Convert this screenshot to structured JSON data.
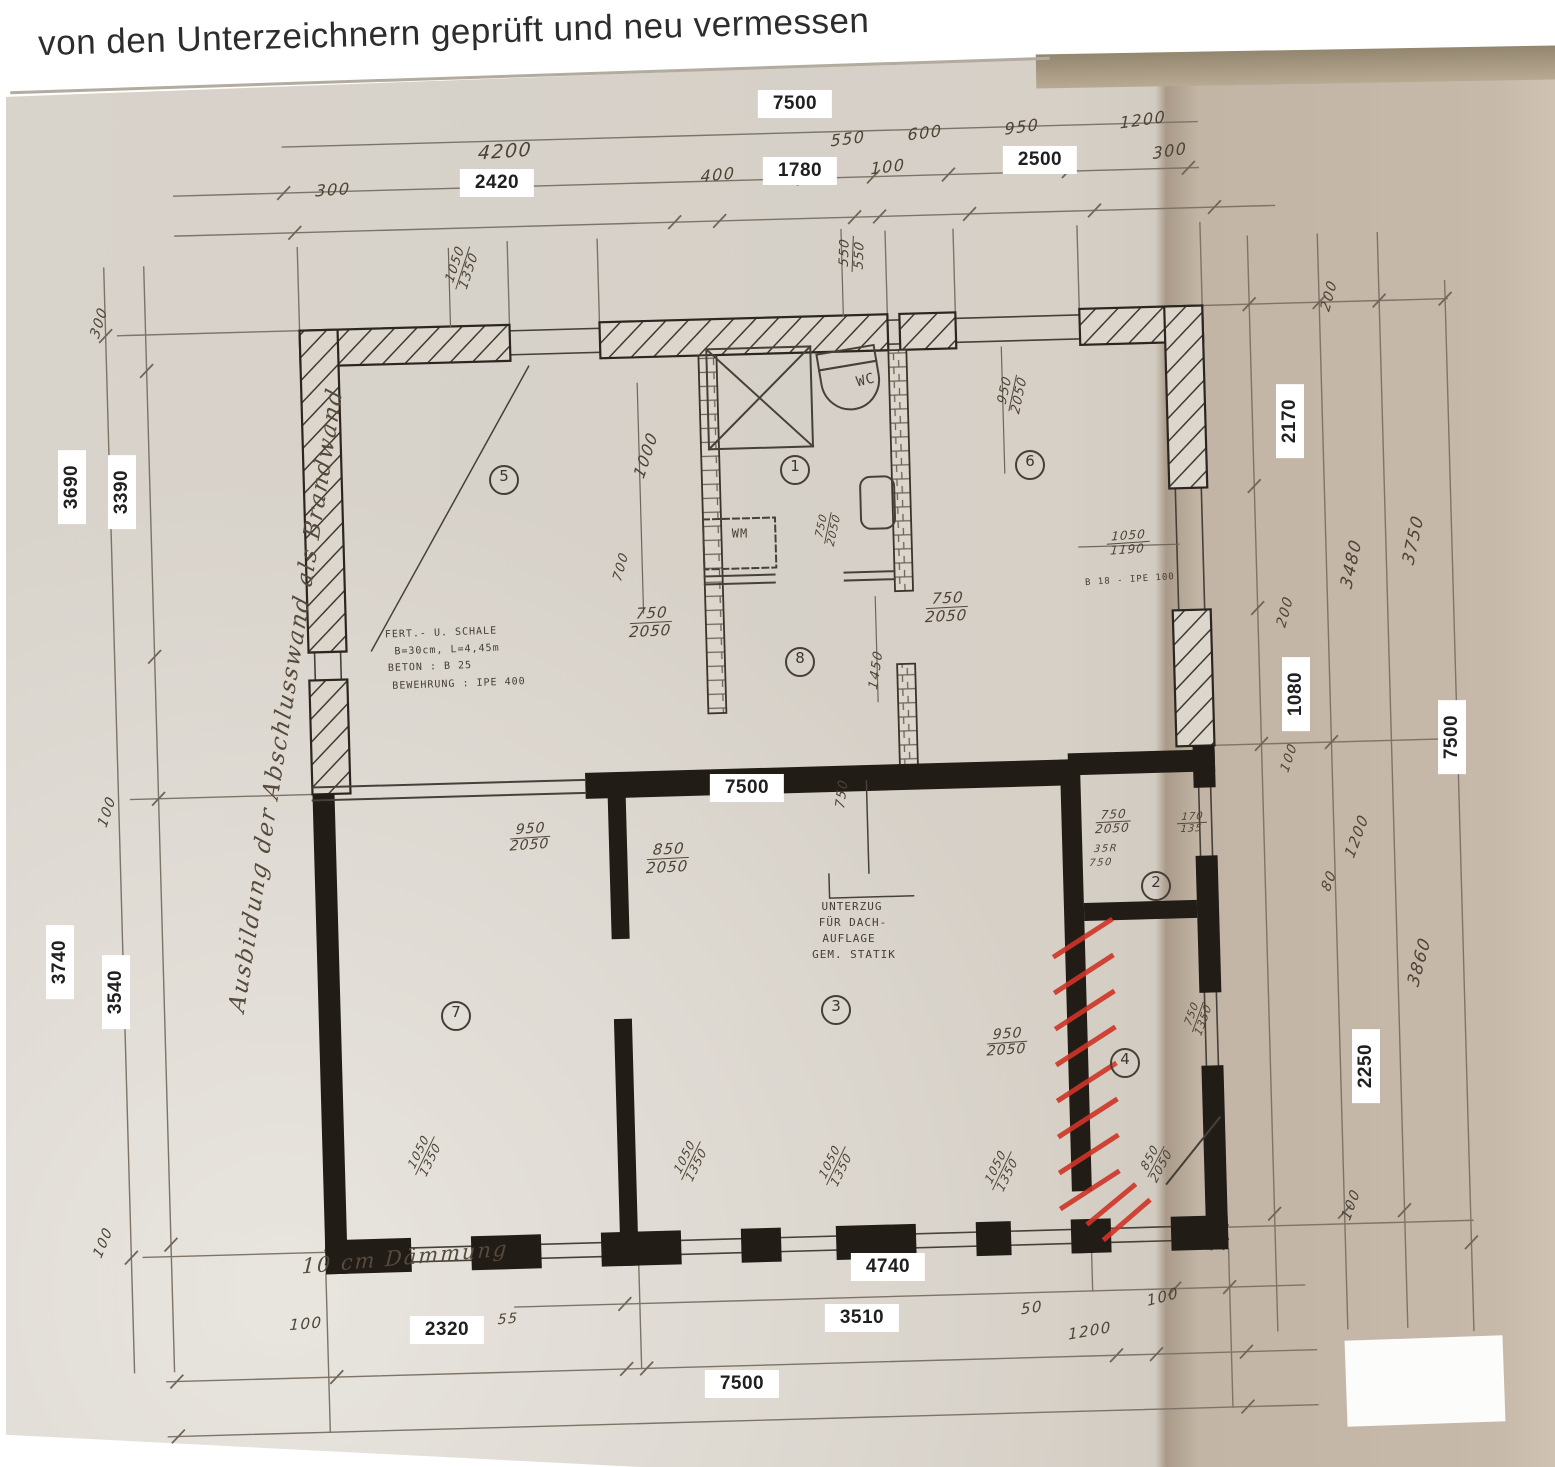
{
  "heading": "von den Unterzeichnern geprüft und neu vermessen",
  "margin_note": "Ausbildung der Abschlusswand als Brandwand",
  "insulation_note": "10 cm Dämmung",
  "beam_note_lines": [
    "UNTERZUG",
    "FÜR DACH-",
    "AUFLAGE",
    "GEM. STATIK"
  ],
  "shell_note_lines": [
    "FERT.- U. SCHALE",
    "B=30cm, L=4,45m",
    "BETON : B 25",
    "BEWEHRUNG : IPE 400"
  ],
  "room_numbers": [
    "1",
    "2",
    "3",
    "4",
    "5",
    "6",
    "7",
    "8"
  ],
  "dimension_chains": {
    "top": [
      [
        "7500"
      ],
      [
        "4200",
        "550",
        "600",
        "950",
        "1200"
      ],
      [
        "300",
        "2420",
        "400",
        "1780",
        "100",
        "2500",
        "300"
      ]
    ],
    "left": [
      [
        "300",
        "3690",
        "100",
        "3740",
        "100"
      ],
      [
        "3390",
        "3540"
      ]
    ],
    "right": [
      [
        "200",
        "2170",
        "200",
        "1080",
        "100",
        "1200",
        "80",
        "100"
      ],
      [
        "3480",
        "3860"
      ],
      [
        "3750",
        "2250"
      ],
      [
        "7500"
      ]
    ],
    "bottom": [
      [
        "4740",
        "50",
        "1200",
        "100"
      ],
      [
        "100",
        "2320",
        "55",
        "3510"
      ],
      [
        "7500"
      ]
    ]
  },
  "labels": [
    {
      "t": "7500",
      "x": 795,
      "y": 104,
      "c": "box"
    },
    {
      "t": "4200",
      "x": 505,
      "y": 152,
      "c": "hand",
      "r": -4,
      "fs": 19
    },
    {
      "t": "550",
      "x": 848,
      "y": 139,
      "c": "hand",
      "r": -7
    },
    {
      "t": "600",
      "x": 925,
      "y": 133,
      "c": "hand",
      "r": -7
    },
    {
      "t": "950",
      "x": 1022,
      "y": 127,
      "c": "hand",
      "r": -8
    },
    {
      "t": "1200",
      "x": 1143,
      "y": 120,
      "c": "hand",
      "r": -8
    },
    {
      "t": "300",
      "x": 333,
      "y": 190,
      "c": "hand",
      "r": -4
    },
    {
      "t": "2420",
      "x": 497,
      "y": 183,
      "c": "box"
    },
    {
      "t": "400",
      "x": 718,
      "y": 175,
      "c": "hand",
      "r": -6
    },
    {
      "t": "1780",
      "x": 800,
      "y": 171,
      "c": "box"
    },
    {
      "t": "100",
      "x": 888,
      "y": 167,
      "c": "hand",
      "r": -7
    },
    {
      "t": "2500",
      "x": 1040,
      "y": 160,
      "c": "box"
    },
    {
      "t": "300",
      "x": 1170,
      "y": 151,
      "c": "hand",
      "r": -9
    },
    {
      "t": "300",
      "x": 100,
      "y": 323,
      "c": "hand",
      "r": -73,
      "fs": 14
    },
    {
      "t": "3690",
      "x": 72,
      "y": 487,
      "c": "box",
      "r": -90
    },
    {
      "t": "3390",
      "x": 122,
      "y": 492,
      "c": "box",
      "r": -90
    },
    {
      "t": "100",
      "x": 108,
      "y": 812,
      "c": "hand",
      "r": -72,
      "fs": 14
    },
    {
      "t": "3740",
      "x": 60,
      "y": 962,
      "c": "box",
      "r": -90
    },
    {
      "t": "3540",
      "x": 116,
      "y": 992,
      "c": "box",
      "r": -90
    },
    {
      "t": "100",
      "x": 104,
      "y": 1243,
      "c": "hand",
      "r": -68,
      "fs": 14
    },
    {
      "t": "Ausbildung der Abschlusswand als Brandwand",
      "x": 287,
      "y": 700,
      "c": "script",
      "r": -81,
      "fs": 23
    },
    {
      "t": "200",
      "x": 1330,
      "y": 296,
      "c": "hand",
      "r": -75,
      "fs": 14
    },
    {
      "t": "2170",
      "x": 1290,
      "y": 421,
      "c": "box",
      "r": -90
    },
    {
      "t": "3480",
      "x": 1352,
      "y": 564,
      "c": "hand",
      "r": -78,
      "fs": 17
    },
    {
      "t": "3750",
      "x": 1414,
      "y": 540,
      "c": "hand",
      "r": -78,
      "fs": 17
    },
    {
      "t": "200",
      "x": 1286,
      "y": 612,
      "c": "hand",
      "r": -75,
      "fs": 14
    },
    {
      "t": "1080",
      "x": 1296,
      "y": 694,
      "c": "box",
      "r": -90
    },
    {
      "t": "100",
      "x": 1290,
      "y": 758,
      "c": "hand",
      "r": -72,
      "fs": 13
    },
    {
      "t": "7500",
      "x": 1452,
      "y": 737,
      "c": "box",
      "r": -90
    },
    {
      "t": "1200",
      "x": 1357,
      "y": 836,
      "c": "hand",
      "r": -70,
      "fs": 15
    },
    {
      "t": "80",
      "x": 1330,
      "y": 881,
      "c": "hand",
      "r": -70,
      "fs": 14
    },
    {
      "t": "3860",
      "x": 1420,
      "y": 962,
      "c": "hand",
      "r": -75,
      "fs": 17
    },
    {
      "t": "2250",
      "x": 1366,
      "y": 1066,
      "c": "box",
      "r": -90
    },
    {
      "t": "100",
      "x": 1352,
      "y": 1205,
      "c": "hand",
      "r": -70,
      "fs": 14
    },
    {
      "t": "100",
      "x": 1163,
      "y": 1297,
      "c": "hand",
      "r": -15,
      "fs": 15
    },
    {
      "t": "50",
      "x": 1032,
      "y": 1308,
      "c": "hand",
      "r": -8,
      "fs": 15
    },
    {
      "t": "1200",
      "x": 1090,
      "y": 1331,
      "c": "hand",
      "r": -10,
      "fs": 15
    },
    {
      "t": "4740",
      "x": 888,
      "y": 1267,
      "c": "box"
    },
    {
      "t": "10 cm Dämmung",
      "x": 405,
      "y": 1258,
      "c": "script",
      "r": -5,
      "fs": 21
    },
    {
      "t": "100",
      "x": 306,
      "y": 1324,
      "c": "hand",
      "r": -5,
      "fs": 15
    },
    {
      "t": "2320",
      "x": 447,
      "y": 1330,
      "c": "box"
    },
    {
      "t": "55",
      "x": 508,
      "y": 1320,
      "c": "hand",
      "r": -5,
      "fs": 14
    },
    {
      "t": "3510",
      "x": 862,
      "y": 1318,
      "c": "box"
    },
    {
      "t": "7500",
      "x": 742,
      "y": 1384,
      "c": "box"
    },
    {
      "t": "1050|1350",
      "x": 463,
      "y": 268,
      "c": "frac",
      "r": -72,
      "fs": 13
    },
    {
      "t": "550|550",
      "x": 853,
      "y": 254,
      "c": "frac",
      "r": -88,
      "fs": 13
    },
    {
      "t": "WC",
      "x": 866,
      "y": 381,
      "c": "print",
      "r": -14,
      "fs": 14
    },
    {
      "t": "5",
      "x": 504,
      "y": 480,
      "c": "circ"
    },
    {
      "t": "1",
      "x": 795,
      "y": 470,
      "c": "circ"
    },
    {
      "t": "6",
      "x": 1030,
      "y": 465,
      "c": "circ"
    },
    {
      "t": "950|2050",
      "x": 1013,
      "y": 393,
      "c": "frac",
      "r": -78,
      "fs": 13
    },
    {
      "t": "1000",
      "x": 646,
      "y": 455,
      "c": "hand",
      "r": -72,
      "fs": 16
    },
    {
      "t": "WM",
      "x": 740,
      "y": 534,
      "c": "print",
      "fs": 12
    },
    {
      "t": "750|2050",
      "x": 828,
      "y": 528,
      "c": "frac",
      "r": -78,
      "fs": 11
    },
    {
      "t": "700",
      "x": 622,
      "y": 567,
      "c": "hand",
      "r": -75,
      "fs": 13
    },
    {
      "t": "750|2050",
      "x": 651,
      "y": 622,
      "c": "frac",
      "r": -3,
      "fs": 15
    },
    {
      "t": "8",
      "x": 800,
      "y": 662,
      "c": "circ"
    },
    {
      "t": "1450",
      "x": 877,
      "y": 670,
      "c": "hand",
      "r": -82,
      "fs": 13
    },
    {
      "t": "750|2050",
      "x": 947,
      "y": 607,
      "c": "frac",
      "r": -3,
      "fs": 15
    },
    {
      "t": "1050|1190",
      "x": 1128,
      "y": 543,
      "c": "frac",
      "r": -4,
      "fs": 12
    },
    {
      "t": "B 18 - IPE 100",
      "x": 1130,
      "y": 581,
      "c": "print",
      "r": -4,
      "fs": 9
    },
    {
      "t": "FERT.- U. SCHALE",
      "x": 441,
      "y": 633,
      "c": "print",
      "r": -2,
      "fs": 10
    },
    {
      "t": "B=30cm, L=4,45m",
      "x": 447,
      "y": 650,
      "c": "print",
      "r": -2,
      "fs": 10
    },
    {
      "t": "BETON : B 25",
      "x": 430,
      "y": 667,
      "c": "print",
      "r": -2,
      "fs": 10
    },
    {
      "t": "BEWEHRUNG : IPE 400",
      "x": 459,
      "y": 684,
      "c": "print",
      "r": -2,
      "fs": 10
    },
    {
      "t": "7500",
      "x": 747,
      "y": 788,
      "c": "box"
    },
    {
      "t": "750",
      "x": 843,
      "y": 794,
      "c": "hand",
      "r": -83,
      "fs": 13
    },
    {
      "t": "950|2050",
      "x": 530,
      "y": 838,
      "c": "frac",
      "r": -4,
      "fs": 14
    },
    {
      "t": "850|2050",
      "x": 668,
      "y": 858,
      "c": "frac",
      "r": -3,
      "fs": 15
    },
    {
      "t": "750|2050",
      "x": 1113,
      "y": 822,
      "c": "frac",
      "r": -3,
      "fs": 12
    },
    {
      "t": "35R",
      "x": 1106,
      "y": 849,
      "c": "hand",
      "r": -3,
      "fs": 10
    },
    {
      "t": "750",
      "x": 1101,
      "y": 863,
      "c": "hand",
      "r": -3,
      "fs": 10
    },
    {
      "t": "170|135",
      "x": 1192,
      "y": 823,
      "c": "frac",
      "r": -3,
      "fs": 10
    },
    {
      "t": "2",
      "x": 1156,
      "y": 886,
      "c": "circ"
    },
    {
      "t": "UNTERZUG",
      "x": 852,
      "y": 907,
      "c": "print",
      "fs": 11
    },
    {
      "t": "FÜR DACH-",
      "x": 853,
      "y": 923,
      "c": "print",
      "fs": 11
    },
    {
      "t": "AUFLAGE",
      "x": 849,
      "y": 939,
      "c": "print",
      "fs": 11
    },
    {
      "t": "GEM. STATIK",
      "x": 854,
      "y": 955,
      "c": "print",
      "fs": 11
    },
    {
      "t": "7",
      "x": 456,
      "y": 1016,
      "c": "circ"
    },
    {
      "t": "3",
      "x": 836,
      "y": 1010,
      "c": "circ"
    },
    {
      "t": "950|2050",
      "x": 1007,
      "y": 1043,
      "c": "frac",
      "r": -4,
      "fs": 14
    },
    {
      "t": "4",
      "x": 1125,
      "y": 1063,
      "c": "circ"
    },
    {
      "t": "750|1350",
      "x": 1198,
      "y": 1017,
      "c": "frac",
      "r": -70,
      "fs": 11
    },
    {
      "t": "1050|1350",
      "x": 425,
      "y": 1156,
      "c": "frac",
      "r": -64,
      "fs": 12
    },
    {
      "t": "1050|1350",
      "x": 691,
      "y": 1161,
      "c": "frac",
      "r": -64,
      "fs": 12
    },
    {
      "t": "1050|1350",
      "x": 836,
      "y": 1166,
      "c": "frac",
      "r": -64,
      "fs": 12
    },
    {
      "t": "1050|1350",
      "x": 1002,
      "y": 1171,
      "c": "frac",
      "r": -64,
      "fs": 12
    },
    {
      "t": "850|2050",
      "x": 1156,
      "y": 1162,
      "c": "frac",
      "r": -62,
      "fs": 12
    }
  ],
  "colors": {
    "red_markup": "#cf3426",
    "wall": "#211c16",
    "paper_left": "#d7d1c8",
    "paper_right": "#c5b7a7"
  }
}
